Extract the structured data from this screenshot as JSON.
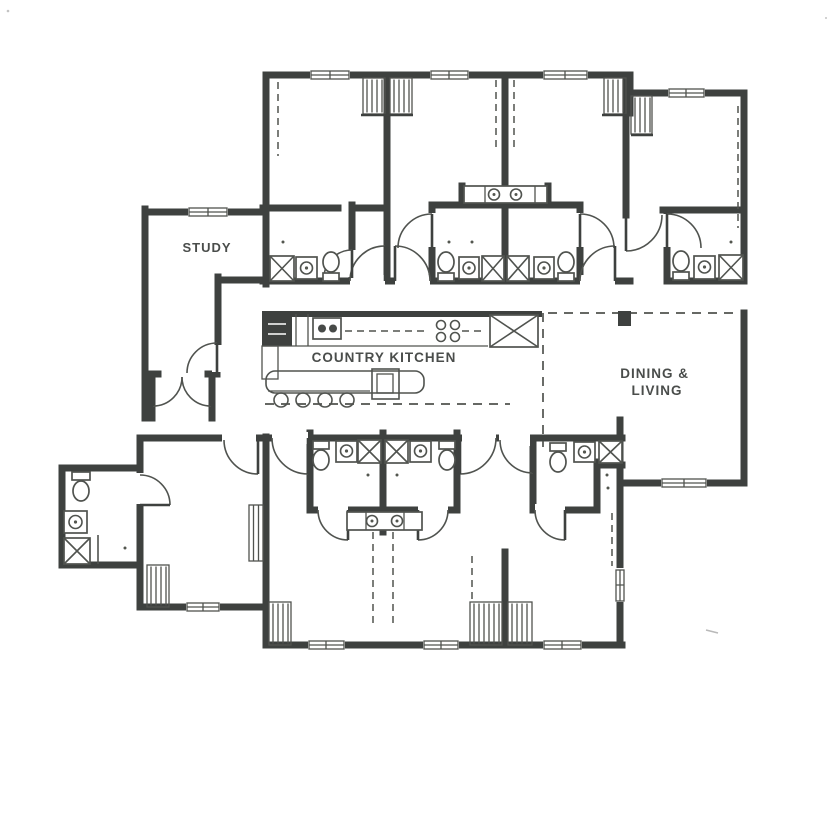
{
  "diagram": {
    "kind": "architectural-floor-plan",
    "rooms": {
      "study": {
        "name": "STUDY"
      },
      "kitchen": {
        "name": "COUNTRY KITCHEN"
      },
      "dining": {
        "name_line1": "DINING &",
        "name_line2": "LIVING"
      }
    },
    "icons": {
      "shower": "square-with-x",
      "toilet": "oval-with-tank",
      "sink": "circle-in-square",
      "vanity-sink": "circle-with-dot",
      "stool": "circle",
      "closet": "hatched-rectangle",
      "closet-rod": "dashed-line",
      "door": "quarter-arc-swing",
      "window": "triple-line-in-wall",
      "range-burners": "four-circles",
      "refrigerator": "box-with-x"
    }
  },
  "colors": {
    "wall": "#3e413f",
    "line": "#50534f",
    "text": "#4a4d4b",
    "paper": "#ffffff"
  }
}
